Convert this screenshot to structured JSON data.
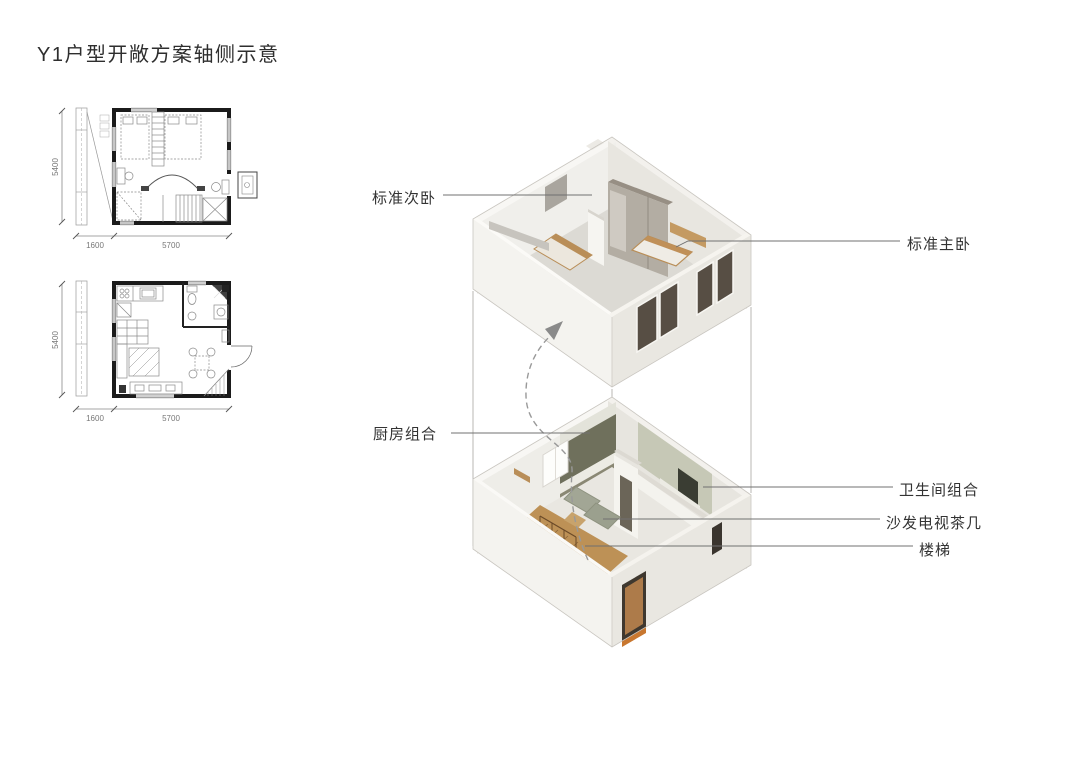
{
  "title": "Y1户型开敞方案轴侧示意",
  "floor_plans": {
    "dim_vertical": "5400",
    "dim_left": "1600",
    "dim_main": "5700"
  },
  "annotations": {
    "secondary_bedroom": "标准次卧",
    "master_bedroom": "标准主卧",
    "kitchen": "厨房组合",
    "bathroom": "卫生间组合",
    "sofa_tv_table": "沙发电视茶几",
    "stairs": "楼梯"
  },
  "colors": {
    "text": "#333333",
    "leader_line": "#707070",
    "plan_wall": "#1b1b1b",
    "wall_light": "#f4f3ef",
    "wall_shaded": "#e9e7e1",
    "floor_gray": "#dcdad4",
    "wood_floor": "#bd9156",
    "wood_furniture": "#b98e58",
    "kitchen_olive_dark": "#6f705c",
    "bathroom_olive": "#c6c8b6",
    "window_glass": "#574e44",
    "door_glow_orange": "#c8772f"
  }
}
